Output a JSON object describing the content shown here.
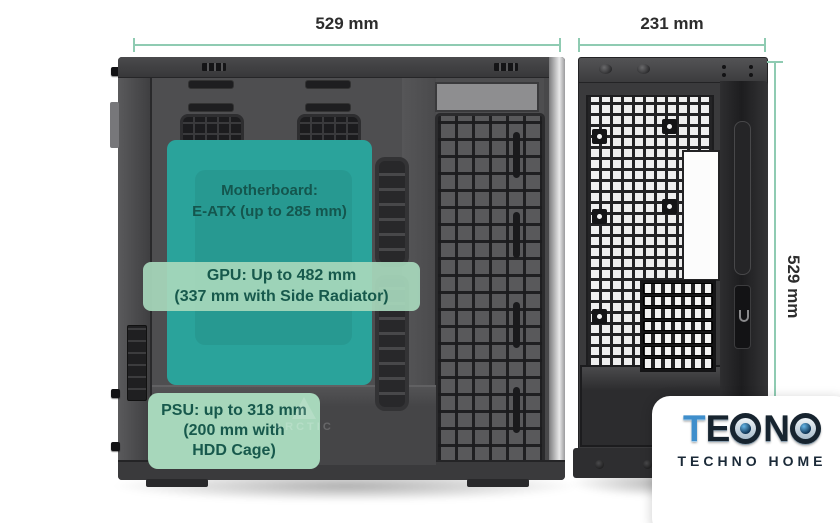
{
  "dimensions": {
    "side_width": "529 mm",
    "front_width": "231 mm",
    "height": "529 mm",
    "line_color": "#8fcbb2",
    "text_color": "#2d2d2d"
  },
  "overlays": {
    "motherboard": {
      "line1": "Motherboard:",
      "line2": "E-ATX (up to 285 mm)",
      "panel_color": "#2aa39b"
    },
    "gpu": {
      "line1": "GPU: Up to 482 mm",
      "line2": "(337 mm with Side Radiator)",
      "panel_color": "#a7d7bb"
    },
    "psu": {
      "line1": "PSU: up to 318 mm",
      "line2": "(200 mm with",
      "line3": "HDD Cage)",
      "panel_color": "#a7d7bb"
    },
    "text_color": "#17594c"
  },
  "watermark": {
    "text": "ARCTIC"
  },
  "logo": {
    "brand": "TEONO",
    "letter_t": "T",
    "letter_e": "E",
    "letter_n": "N",
    "tagline": "TECHNO HOME",
    "accent_color": "#3f8ecb",
    "dark_color": "#17242f"
  }
}
